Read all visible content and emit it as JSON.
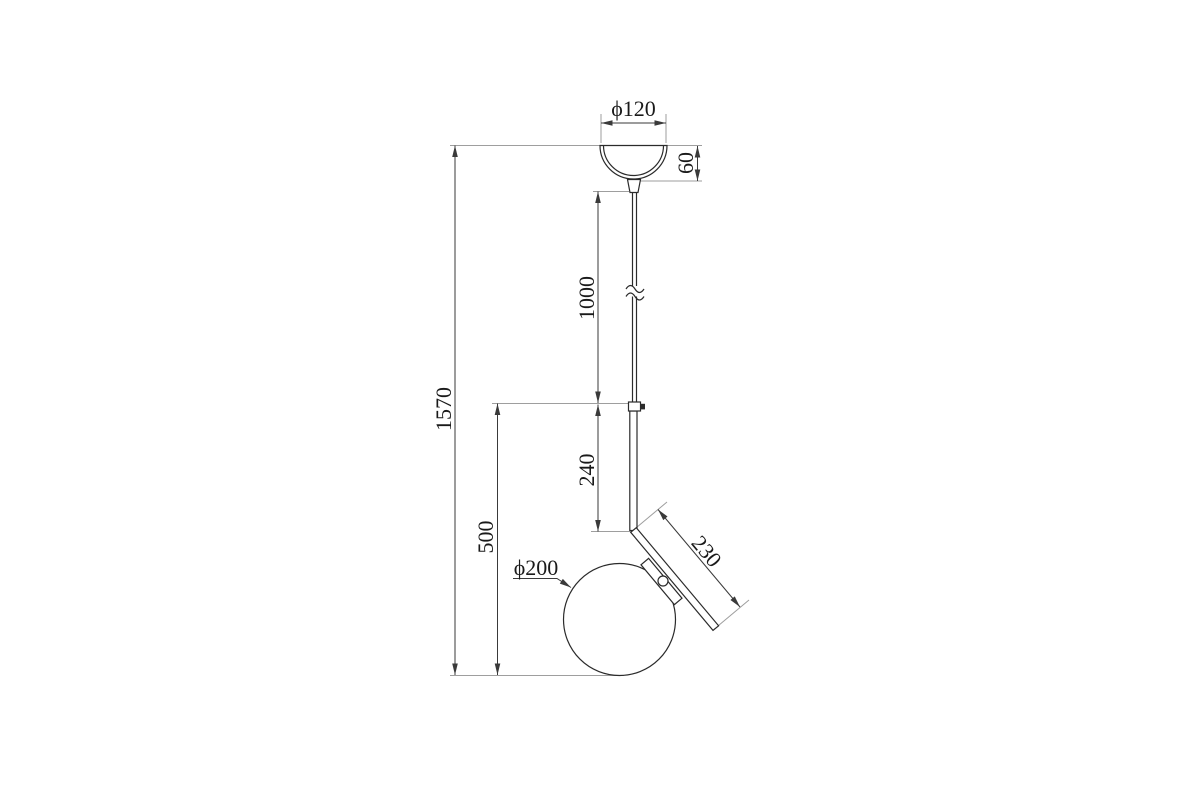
{
  "drawing": {
    "subject": "pendant-lamp-dimension-drawing",
    "units": "mm",
    "colors": {
      "background": "#ffffff",
      "part_line": "#2b2b2b",
      "dimension_line": "#3a3a3a",
      "extension_line": "#9e9e9e",
      "text": "#1a1a1a"
    },
    "dimensions": {
      "canopy_diameter": "ϕ120",
      "canopy_height": "60",
      "cable_length": "1000",
      "total_height": "1570",
      "stem_length": "240",
      "arm_length": "230",
      "globe_drop": "500",
      "globe_diameter": "ϕ200"
    }
  }
}
